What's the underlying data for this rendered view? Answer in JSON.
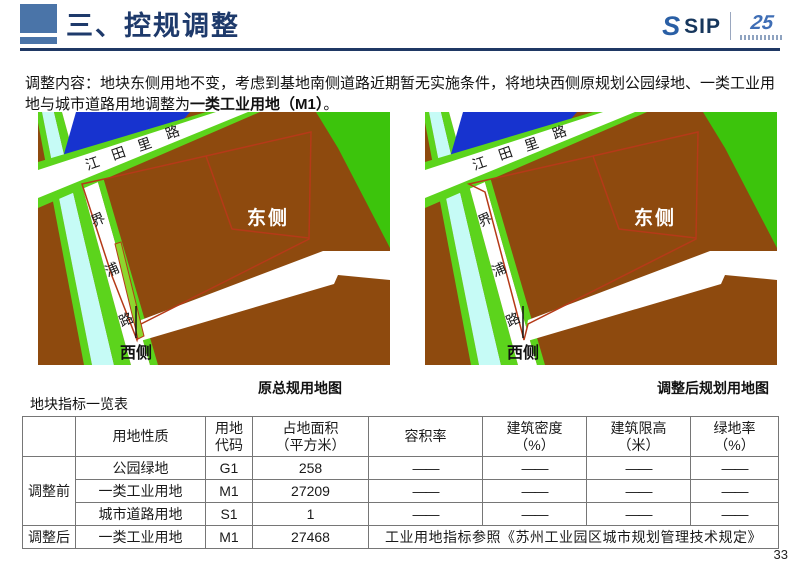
{
  "header": {
    "title": "三、控规调整",
    "logo": {
      "s": "S",
      "sip": "SIP",
      "anniversary": "25"
    }
  },
  "intro": {
    "lead": "调整内容：地块东侧用地不变，考虑到基地南侧道路近期暂无实施条件，将地块西侧原规划公园绿地、一类工业用地与城市道路用地调整为",
    "emphasis": "一类工业用地（M1）",
    "period": "。"
  },
  "maps": {
    "left_caption": "原总规用地图",
    "right_caption": "调整后规划用地图",
    "east_label": "东侧",
    "west_label": "西侧",
    "road_jiangtianli": [
      "江",
      "田",
      "里",
      "路"
    ],
    "road_jiepu": [
      "界",
      "浦",
      "路"
    ]
  },
  "colors": {
    "accent_blue": "#4a74a8",
    "title_navy": "#1e3a6b",
    "rule_navy": "#1f3864",
    "map_brown": "#8e4a0e",
    "map_green": "#3cc40c",
    "map_edge_green": "#5cd41c",
    "map_blue": "#1733cf",
    "map_cyan": "#c6fbf6",
    "map_red": "#b53a18",
    "sliver_green": "#8ed62e",
    "table_red": "#c00000",
    "road_white": "#ffffff"
  },
  "table": {
    "title": "地块指标一览表",
    "headers": [
      {
        "l1": "",
        "l2": ""
      },
      {
        "l1": "用地性质",
        "l2": ""
      },
      {
        "l1": "用地",
        "l2": "代码"
      },
      {
        "l1": "占地面积",
        "l2": "（平方米）"
      },
      {
        "l1": "容积率",
        "l2": ""
      },
      {
        "l1": "建筑密度",
        "l2": "（%）"
      },
      {
        "l1": "建筑限高",
        "l2": "（米）"
      },
      {
        "l1": "绿地率",
        "l2": "（%）"
      }
    ],
    "group_labels": [
      "调整前",
      "调整后"
    ],
    "rows": [
      [
        "公园绿地",
        "G1",
        "258",
        "——",
        "——",
        "——",
        "——"
      ],
      [
        "一类工业用地",
        "M1",
        "27209",
        "——",
        "——",
        "——",
        "——"
      ],
      [
        "城市道路用地",
        "S1",
        "1",
        "——",
        "——",
        "——",
        "——"
      ],
      [
        "一类工业用地",
        "M1",
        "27468"
      ]
    ],
    "note": "工业用地指标参照《苏州工业园区城市规划管理技术规定》"
  },
  "page_number": "33"
}
